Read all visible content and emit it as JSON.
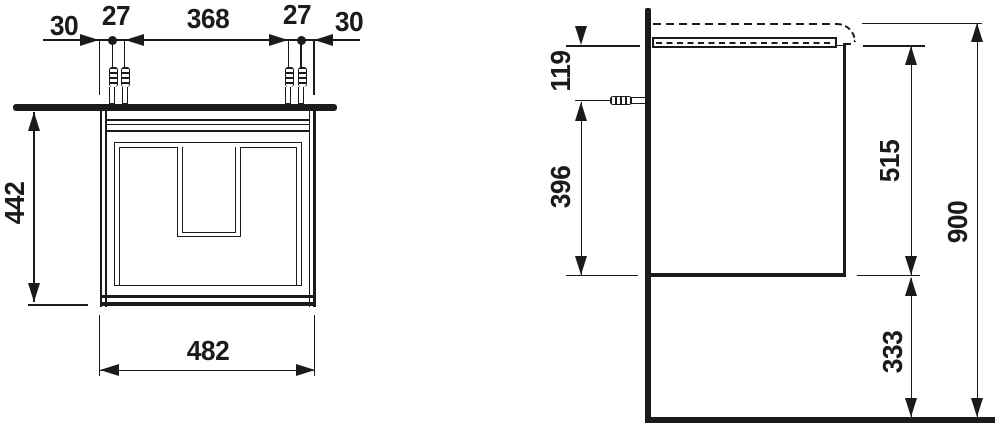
{
  "front_view": {
    "top_dims": [
      "30",
      "27",
      "368",
      "27",
      "30"
    ],
    "height": "442",
    "width": "482"
  },
  "side_view": {
    "top_offset": "119",
    "lower_span": "396",
    "body_height": "515",
    "floor_clearance": "333",
    "total_height": "900"
  },
  "colors": {
    "ink": "#1b1b1b",
    "background": "#ffffff"
  }
}
